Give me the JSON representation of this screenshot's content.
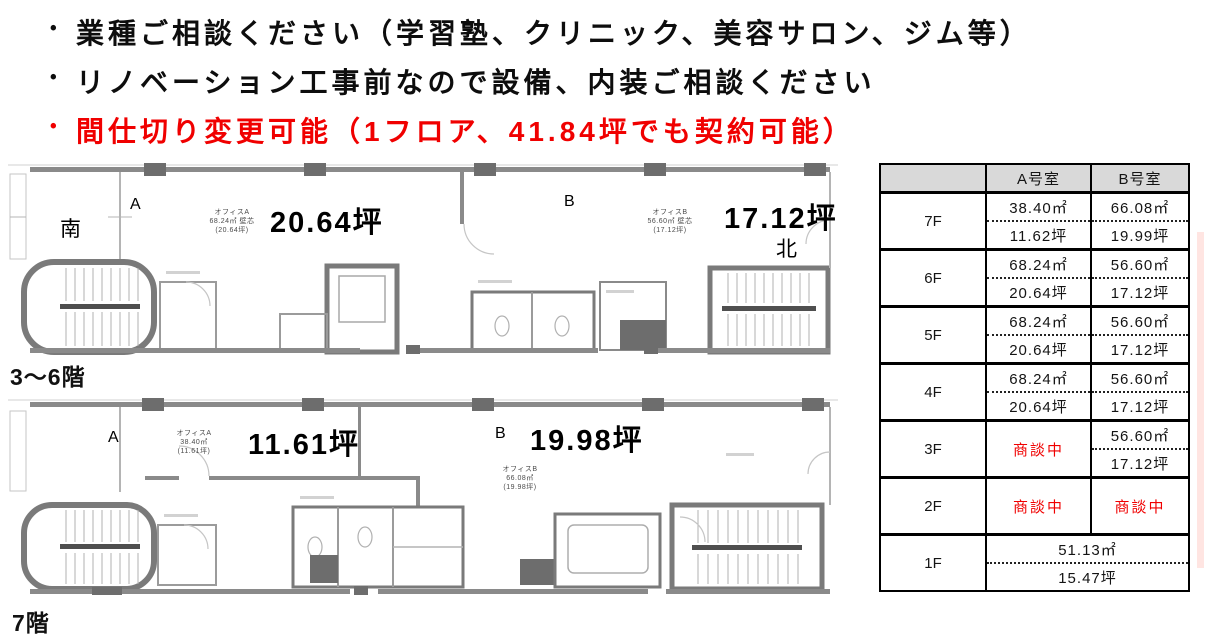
{
  "colors": {
    "accent_red": "#ff0000",
    "table_header_bg": "#d9d9d9"
  },
  "bullets": [
    {
      "text": "業種ご相談ください（学習塾、クリニック、美容サロン、ジム等）",
      "color": "#000000"
    },
    {
      "text": "リノベーション工事前なので設備、内装ご相談ください",
      "color": "#000000"
    },
    {
      "text": "間仕切り変更可能（1フロア、41.84坪でも契約可能）",
      "color": "#ff0000"
    }
  ],
  "plans": {
    "upper": {
      "caption": "3～6階",
      "direction_south": "南",
      "direction_north": "北",
      "unit_a_label": "A",
      "unit_b_label": "B",
      "unit_a_area": "20.64坪",
      "unit_b_area": "17.12坪",
      "office_a_note": [
        "オフィスA",
        "68.24㎡ 壁芯",
        "(20.64坪)"
      ],
      "office_b_note": [
        "オフィスB",
        "56.60㎡ 壁芯",
        "(17.12坪)"
      ]
    },
    "lower": {
      "caption": "7階",
      "unit_a_label": "A",
      "unit_b_label": "B",
      "unit_a_area": "11.61坪",
      "unit_b_area": "19.98坪",
      "office_a_note": [
        "オフィスA",
        "38.40㎡",
        "(11.61坪)"
      ],
      "office_b_note": [
        "オフィスB",
        "66.08㎡",
        "(19.98坪)"
      ]
    }
  },
  "table": {
    "headers": [
      "",
      "A号室",
      "B号室"
    ],
    "rows": [
      {
        "floor": "7F",
        "a": {
          "m2": "38.40㎡",
          "tsubo": "11.62坪"
        },
        "b": {
          "m2": "66.08㎡",
          "tsubo": "19.99坪"
        }
      },
      {
        "floor": "6F",
        "a": {
          "m2": "68.24㎡",
          "tsubo": "20.64坪"
        },
        "b": {
          "m2": "56.60㎡",
          "tsubo": "17.12坪"
        }
      },
      {
        "floor": "5F",
        "a": {
          "m2": "68.24㎡",
          "tsubo": "20.64坪"
        },
        "b": {
          "m2": "56.60㎡",
          "tsubo": "17.12坪"
        }
      },
      {
        "floor": "4F",
        "a": {
          "m2": "68.24㎡",
          "tsubo": "20.64坪"
        },
        "b": {
          "m2": "56.60㎡",
          "tsubo": "17.12坪"
        }
      },
      {
        "floor": "3F",
        "a": {
          "status": "商談中"
        },
        "b": {
          "m2": "56.60㎡",
          "tsubo": "17.12坪"
        }
      },
      {
        "floor": "2F",
        "a": {
          "status": "商談中"
        },
        "b": {
          "status": "商談中"
        }
      },
      {
        "floor": "1F",
        "merged": {
          "m2": "51.13㎡",
          "tsubo": "15.47坪"
        }
      }
    ]
  }
}
